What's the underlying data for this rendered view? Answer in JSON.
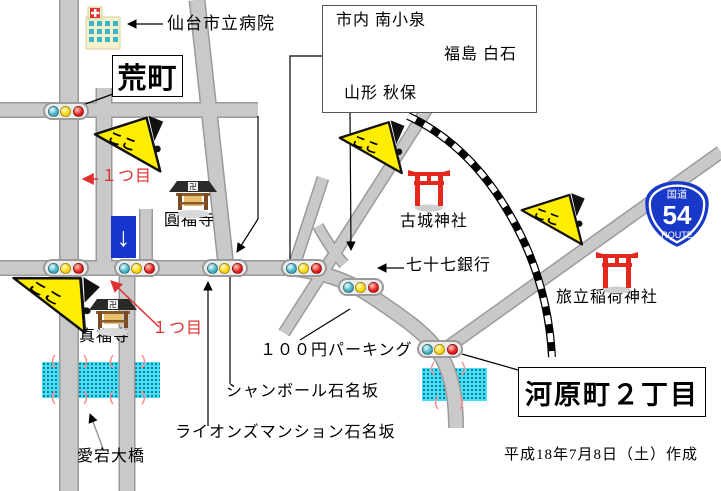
{
  "map": {
    "hospital_label": "仙台市立病院",
    "aramachi": "荒町",
    "kawaramachi": "河原町２丁目",
    "direction_box": {
      "top_left": "市内 南小泉",
      "right": "福島 白石",
      "bottom_left": "山形 秋保"
    },
    "route_badge": {
      "kanji": "国道",
      "number": "54",
      "word": "ROUTE"
    },
    "temples": {
      "enpukuji": "圓福寺",
      "shinpukuji": "真福寺",
      "manji": "卍"
    },
    "shrines": {
      "kojo": "古城神社",
      "tabidachi": "旅立稲荷神社"
    },
    "landmarks": {
      "bank": "七十七銀行",
      "parking": "１００円パーキング",
      "chambord": "シャンボール石名坂",
      "lions": "ライオンズマンション石名坂",
      "bridge": "愛宕大橋"
    },
    "annotations": {
      "here": "ここ",
      "first_top": "１つ目",
      "first_bottom": "１つ目",
      "oneway_arrow": "↓",
      "date": "平成18年7月8日（土）作成"
    },
    "colors": {
      "road_fill": "#c9c9c9",
      "road_edge": "#9a9a9a",
      "river": "#45e0f8",
      "marker_yellow": "#ffee00",
      "red_annotation": "#e03030",
      "signal_teal": "#3fb0c0",
      "signal_yellow": "#ffd60a",
      "signal_red": "#e21b1b",
      "route_blue": "#1838c8",
      "oneway_blue": "#1535cc",
      "torii_red": "#e5281e"
    }
  }
}
